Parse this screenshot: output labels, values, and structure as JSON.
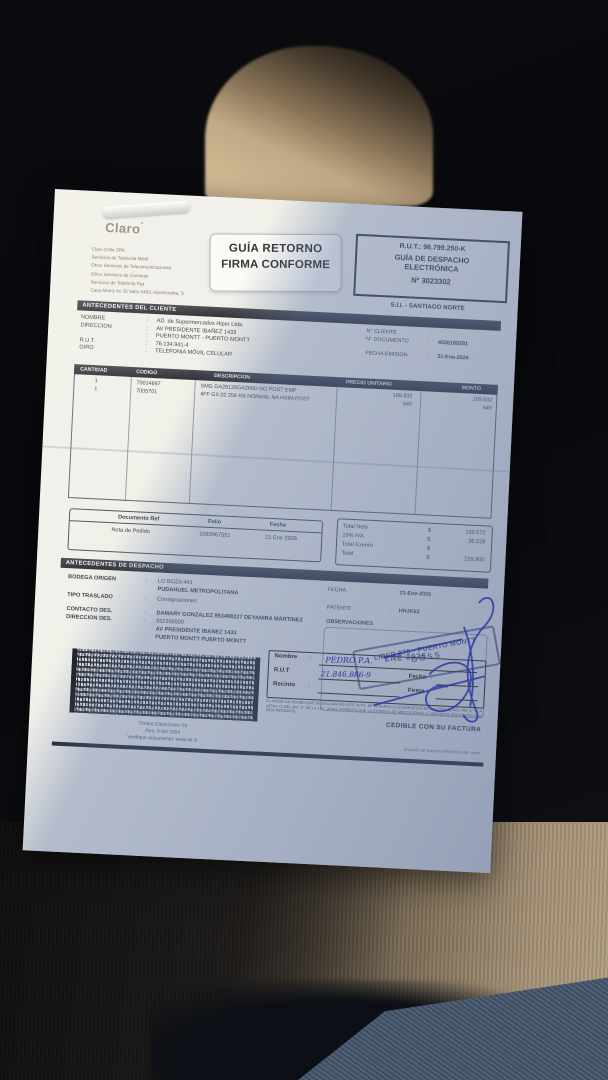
{
  "scene": {
    "description": "photo of a Claro Chile dispatch guide document lying on a car seat, diagonal sunlight shadow",
    "colors": {
      "paper_lit": "#f1f0ea",
      "paper_shadow": "#aebcd6",
      "seat_tan": "#c9b18c",
      "fabric_khaki": "#a8957a",
      "signature_blue": "#2636a0",
      "stamp_blue": "#3e4a76",
      "background_dark": "#0b0c10"
    }
  },
  "punct": {
    "colon": ":"
  },
  "icons": {
    "claro_antenna": "ˇ"
  },
  "header": {
    "brand": "Claro",
    "company_lines": [
      "Claro Chile SPA",
      "Servicios de Telefonía Móvil",
      "Otros Servicios de Telecomunicaciones",
      "Otros Servicios de Corretaje",
      "Servicios de Telefonía Fija",
      "Casa Matriz Av. El Salto 5450, Huechuraba, S"
    ],
    "sticker": {
      "line1": "GUÍA RETORNO",
      "line2": "FIRMA CONFORME"
    },
    "rut_box": {
      "rut": "R.U.T.: 96.799.250-K",
      "type1": "GUÍA DE DESPACHO",
      "type2": "ELECTRÓNICA",
      "number": "Nº 3023302"
    },
    "sii_office": "S.I.I. - SANTIAGO NORTE"
  },
  "client": {
    "title": "ANTECEDENTES DEL CLIENTE",
    "rows": [
      {
        "label": "NOMBRE",
        "value": "AD. de Supermercados Hiper Ltda."
      },
      {
        "label": "DIRECCION",
        "value": "AV PRESIDENTE IBAÑEZ 1433"
      },
      {
        "label": "",
        "value": "PUERTO MONTT -  PUERTO MONTT"
      },
      {
        "label": "R.U.T.",
        "value": "76.134.941-4"
      },
      {
        "label": "GIRO",
        "value": "TELEFONIA MÓVIL CELULAR"
      }
    ],
    "right": [
      {
        "label": "N° CLIENTE",
        "value": ""
      },
      {
        "label": "N° DOCUMENTO",
        "value": "4026189281"
      },
      {
        "label": "FECHA EMISION",
        "value": "21-Ene-2026"
      }
    ]
  },
  "table": {
    "headers": [
      "CANTIDAD",
      "CODIGO",
      "DESCRIPCION",
      "PRECIO UNITARIO",
      "MONTO"
    ],
    "rows": [
      {
        "cantidad": "1",
        "codigo": "70014897",
        "descripcion": "SMG GA26128GA266D NG POST EMP",
        "precio": "189.832",
        "monto": "189.832"
      },
      {
        "cantidad": "1",
        "codigo": "7005701",
        "descripcion": "4FF GX.02 256 KB NORMAL NA HSIM POST",
        "precio": "640",
        "monto": "640"
      }
    ]
  },
  "refbox": {
    "headers": [
      "Documento Ref",
      "Folio",
      "Fecha"
    ],
    "row": [
      "Nota de Pedido",
      "1083967551",
      "21 Ene 2026"
    ]
  },
  "totals": {
    "rows": [
      {
        "label": "Total Neto",
        "currency": "$",
        "value": "190.672"
      },
      {
        "label": "19% IVA",
        "currency": "$",
        "value": "36.228"
      },
      {
        "label": "Total Exento",
        "currency": "$",
        "value": ""
      },
      {
        "label": "Total",
        "currency": "$",
        "value": "226.900"
      }
    ]
  },
  "dispatch": {
    "title": "ANTECEDENTES DE DESPACHO",
    "rows": [
      {
        "label": "BODEGA ORIGEN",
        "value": "LO BOZA 441"
      },
      {
        "label": "",
        "value": "PUDAHUEL  METROPOLITANA"
      },
      {
        "label": "TIPO TRASLADO",
        "value": "Consignaciones"
      },
      {
        "label": "CONTACTO DES.",
        "value": "DAMARY GONZALEZ 953498227 DEYANIRA MARTINEZ"
      },
      {
        "label": "DIRECCION DES.",
        "value": "932398500"
      },
      {
        "label": "",
        "value": "AV PRESIDENTE IBANEZ 1433"
      },
      {
        "label": "",
        "value": "PUERTO MONTT   PUERTO MONTT"
      }
    ],
    "right": [
      {
        "label": "FECHA",
        "value": "21-Ene-2026"
      },
      {
        "label": "PATENTE",
        "value": "HHJK63"
      }
    ],
    "observaciones": "OBSERVACIONES"
  },
  "stamps": {
    "dealer_line1": "LIDER 870 - PUERTO MONTT",
    "dealer_line2": "GGSS",
    "date_stamp": "ENE 2026"
  },
  "barcode": {
    "captions": [
      "Timbre Electrónico SII",
      "Res. 0 del 2004",
      "Verifique documento: www.sii.cl"
    ]
  },
  "receipt": {
    "labels": {
      "nombre": "Nombre",
      "rut": "R.U.T",
      "recinto": "Recinto",
      "fecha": "Fecha",
      "firma": "Firma"
    },
    "handwriting": {
      "nombre": "PEDRO P.A.",
      "rut": "21.846.886-9"
    },
    "legal": "EL ACUSE DE RECIBO QUE SE DECLARA EN ESTE ACTO, DE ACUERDO A LO DISPUESTO EN LA LETRA B) DEL ART. 4° Y LA LETRA C) DEL ART. 5° DE LA LEY 19.983, ACREDITA QUE LA ENTREGA DE MERCADERIAS O SERVICIOS PRESTADOS HAN SIDO RECIBIDOS.",
    "cedible": "CEDIBLE CON SU FACTURA"
  },
  "footer": {
    "provider": "Solución de Factura Electrónica de: www"
  }
}
